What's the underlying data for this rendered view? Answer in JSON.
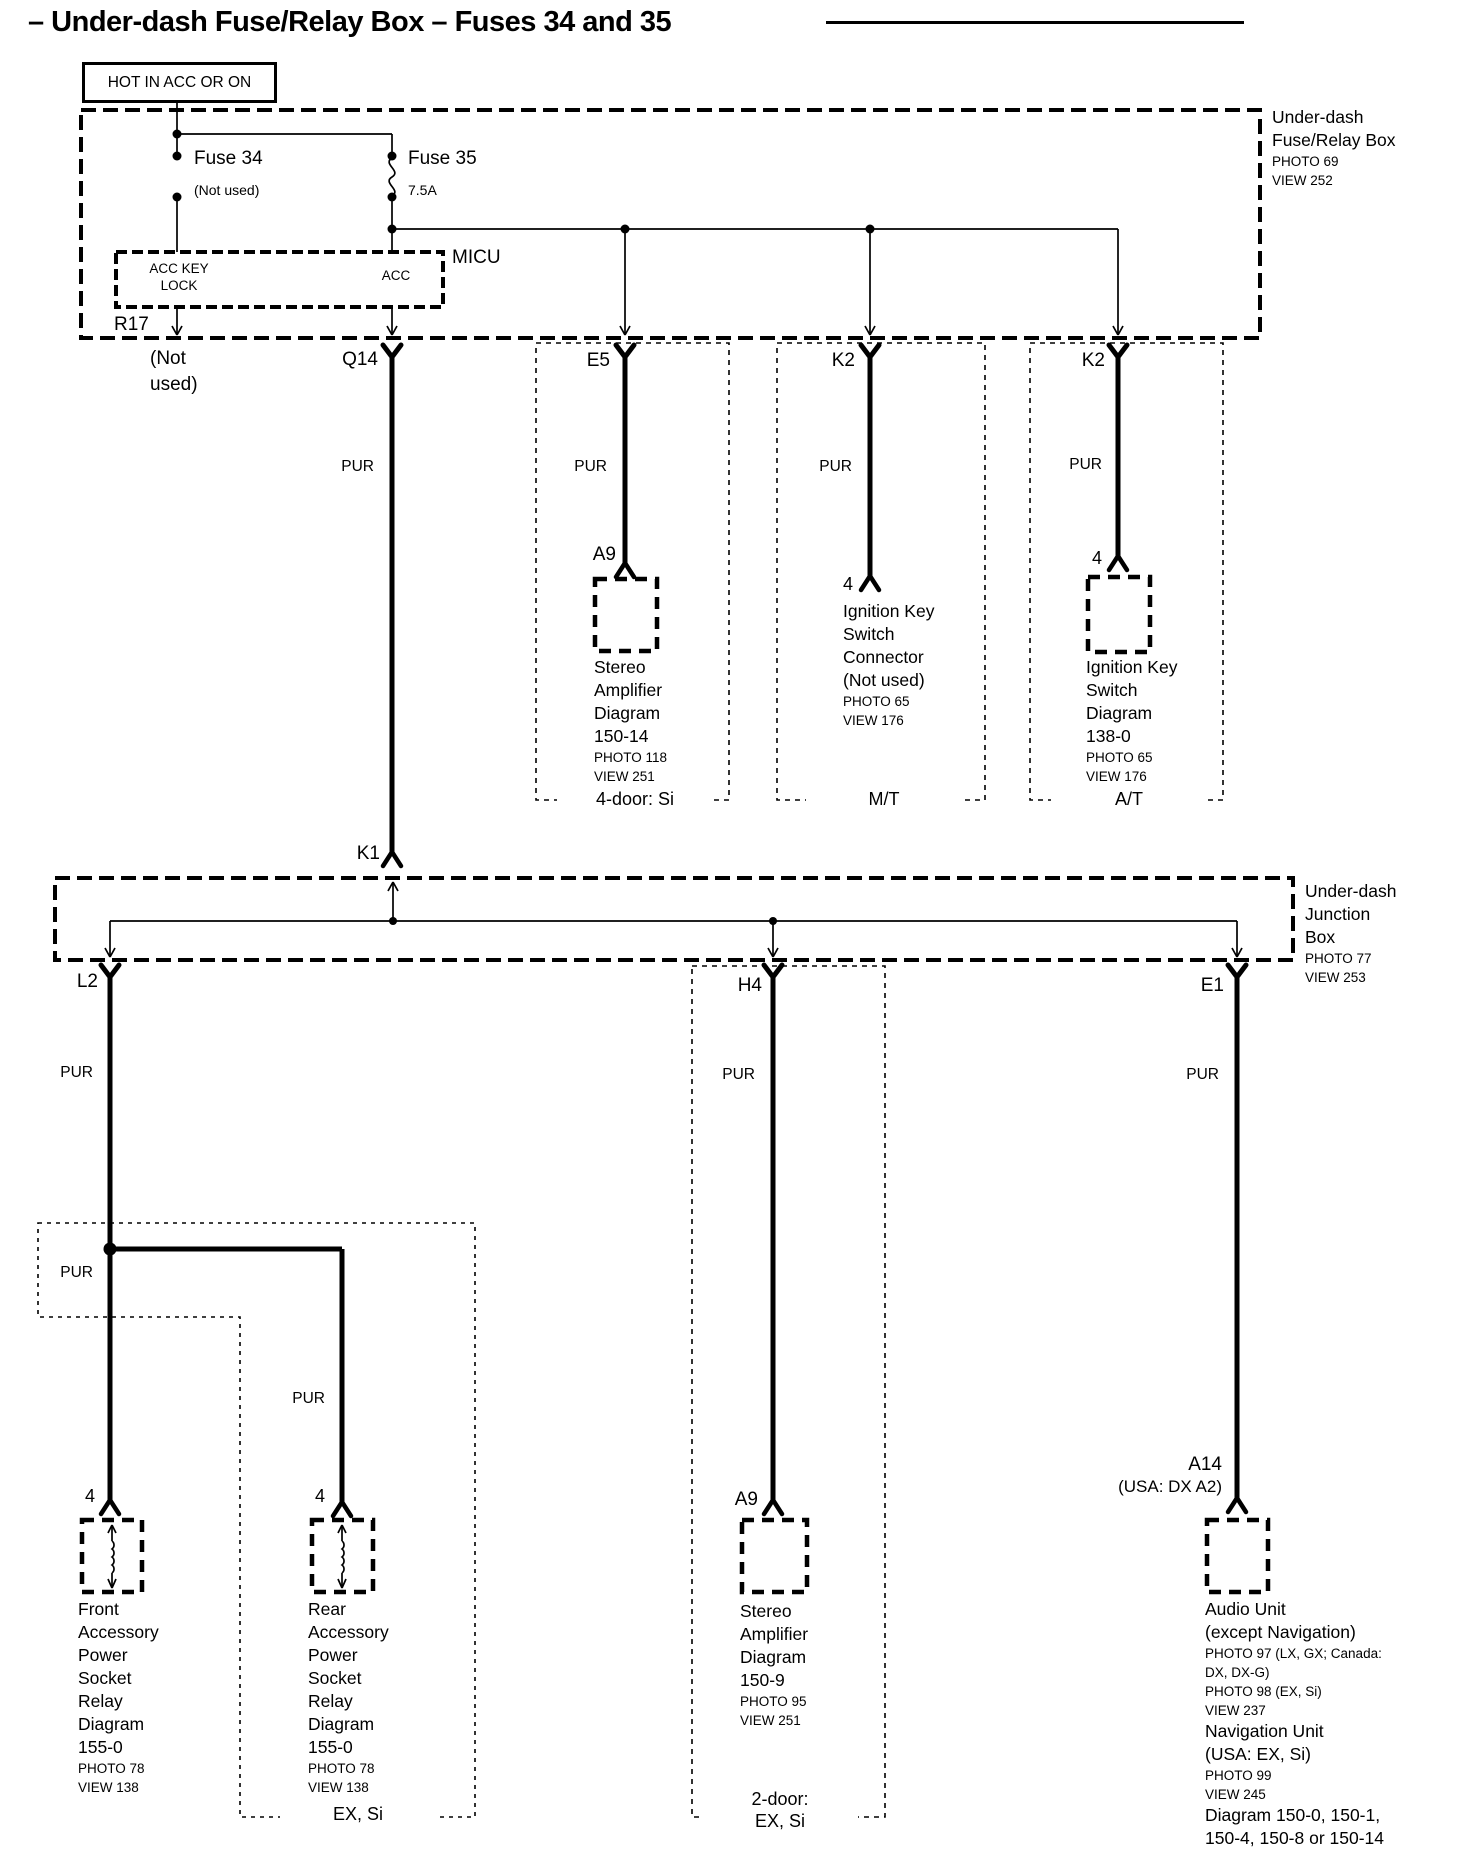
{
  "title": {
    "text": "– Under-dash Fuse/Relay Box – Fuses 34 and 35"
  },
  "power_source": "HOT IN ACC OR ON",
  "wire_color": "PUR",
  "fuse_relay_box": {
    "name_line1": "Under-dash",
    "name_line2": "Fuse/Relay Box",
    "photo": "PHOTO 69",
    "view": "VIEW 252",
    "fuse34_label": "Fuse 34",
    "fuse34_note": "(Not used)",
    "fuse35_label": "Fuse 35",
    "fuse35_rating": "7.5A",
    "micu_label": "MICU",
    "micu_pin_left_line1": "ACC KEY",
    "micu_pin_left_line2": "LOCK",
    "micu_pin_right": "ACC",
    "r17": "R17"
  },
  "junction_box": {
    "name_line1": "Under-dash",
    "name_line2": "Junction",
    "name_line3": "Box",
    "photo": "PHOTO 77",
    "view": "VIEW 253"
  },
  "connectors": {
    "not_used_line1": "(Not",
    "not_used_line2": "used)",
    "q14": "Q14",
    "e5": "E5",
    "k2_mt": "K2",
    "k2_at": "K2",
    "k1": "K1",
    "l2": "L2",
    "h4": "H4",
    "e1": "E1",
    "a9_top": "A9",
    "a9_bottom": "A9",
    "pin4_mt": "4",
    "pin4_at": "4",
    "pin4_front": "4",
    "pin4_rear": "4",
    "a14": "A14",
    "a14_note": "(USA: DX A2)"
  },
  "components": {
    "stereo_amp_top": {
      "lines": [
        "Stereo",
        "Amplifier",
        "Diagram",
        "150-14"
      ],
      "refs": [
        "PHOTO 118",
        "VIEW 251"
      ]
    },
    "ignition_connector": {
      "lines": [
        "Ignition Key",
        "Switch",
        "Connector",
        "(Not used)"
      ],
      "refs": [
        "PHOTO 65",
        "VIEW 176"
      ]
    },
    "ignition_switch": {
      "lines": [
        "Ignition Key",
        "Switch",
        "Diagram",
        "138-0"
      ],
      "refs": [
        "PHOTO 65",
        "VIEW 176"
      ]
    },
    "front_socket": {
      "lines": [
        "Front",
        "Accessory",
        "Power",
        "Socket",
        "Relay",
        "Diagram",
        "155-0"
      ],
      "refs": [
        "PHOTO 78",
        "VIEW 138"
      ]
    },
    "rear_socket": {
      "lines": [
        "Rear",
        "Accessory",
        "Power",
        "Socket",
        "Relay",
        "Diagram",
        "155-0"
      ],
      "refs": [
        "PHOTO 78",
        "VIEW 138"
      ]
    },
    "stereo_amp_bottom": {
      "lines": [
        "Stereo",
        "Amplifier",
        "Diagram",
        "150-9"
      ],
      "refs": [
        "PHOTO 95",
        "VIEW 251"
      ]
    },
    "audio_unit": {
      "lines1": [
        "Audio Unit",
        "(except Navigation)"
      ],
      "refs1": [
        "PHOTO 97 (LX, GX; Canada:",
        "DX, DX-G)",
        "PHOTO 98 (EX, Si)",
        "VIEW 237"
      ],
      "lines2": [
        "Navigation Unit",
        "(USA: EX, Si)"
      ],
      "refs2": [
        "PHOTO 99",
        "VIEW 245"
      ],
      "lines3": [
        "Diagram 150-0, 150-1,",
        "150-4, 150-8 or 150-14"
      ]
    }
  },
  "regions": {
    "four_door_si": "4-door: Si",
    "mt": "M/T",
    "at": "A/T",
    "ex_si": "EX, Si",
    "two_door_line1": "2-door:",
    "two_door_line2": "EX, Si"
  }
}
